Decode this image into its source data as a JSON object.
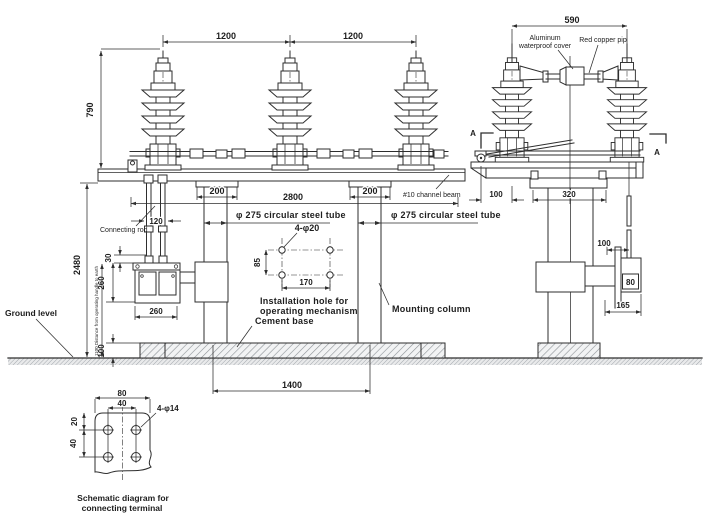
{
  "colors": {
    "ink": "#2e2e2e",
    "hatch_gray": "#8d9296",
    "background": "#ffffff"
  },
  "front_view": {
    "dim_span_left": "1200",
    "dim_span_right": "1200",
    "dim_insulator_height": "790",
    "dim_total_height": "2480",
    "dim_cap_left": "200",
    "dim_cap_right": "200",
    "dim_beam_span": "2800",
    "label_steel_tube_left": "φ 275 circular steel tube",
    "label_steel_tube_right": "φ 275 circular steel tube",
    "label_channel_beam": "#10 channel beam",
    "label_mounting_column": "Mounting column",
    "label_connecting_rod": "Connecting rod",
    "dim_rod_gap": "120",
    "dim_rod_offset": "30",
    "dim_mech_height": "260",
    "dim_mech_width": "260",
    "dim_base_height": "100",
    "dim_column_spacing": "1400",
    "label_ground_level": "Ground level",
    "note_handle_distance": "1100 Distance from operating handle to earth",
    "install_hole": {
      "line1": "Installation hole for",
      "line2": "operating mechanism",
      "label": "4-φ20",
      "dim_v": "85",
      "dim_h": "170"
    },
    "label_cement_base": "Cement base"
  },
  "side_view": {
    "dim_top_span": "590",
    "cover_label_line1": "Aluminum",
    "cover_label_line2": "waterproof cover",
    "label_pipe": "Red copper pip",
    "section_left": "A",
    "section_right": "A",
    "dim_pivot_offset": "100",
    "dim_pedestal_width": "320",
    "dim_rod_offset": "100",
    "dim_box_width": "80",
    "dim_mech_width": "165"
  },
  "terminal_schematic": {
    "dim_width": "80",
    "dim_hole_spacing_h": "40",
    "label_holes": "4-φ14",
    "dim_top_offset": "20",
    "dim_hole_spacing_v": "40",
    "caption_line1": "Schematic diagram for",
    "caption_line2": "connecting terminal"
  }
}
